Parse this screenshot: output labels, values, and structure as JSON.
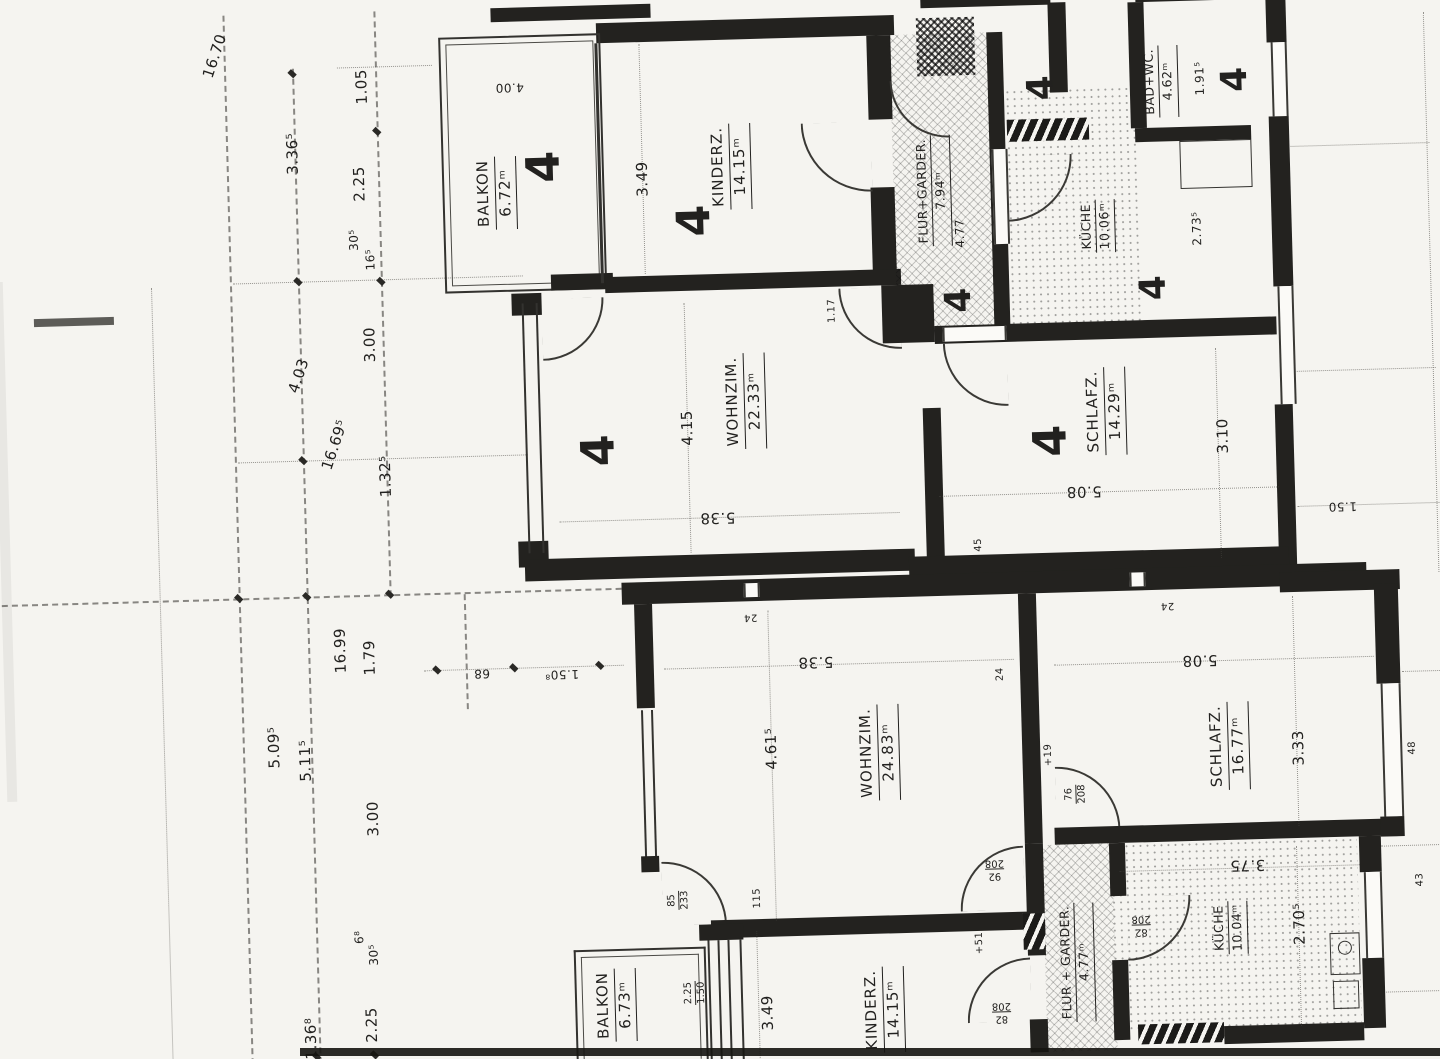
{
  "plan": {
    "unit_number": "4",
    "rooms": [
      {
        "name": "BALKON",
        "area": "6.72ᵐ"
      },
      {
        "name": "KINDERZ.",
        "area": "14.15ᵐ"
      },
      {
        "name": "WOHNZIM.",
        "area": "22.33ᵐ"
      },
      {
        "name": "FLUR+GARDER.",
        "area": "7.94ᵐ"
      },
      {
        "name": "KÜCHE",
        "area": "10.06ᵐ"
      },
      {
        "name": "BAD+WC.",
        "area": "4.62ᵐ"
      },
      {
        "name": "SCHLAFZ.",
        "area": "14.29ᵐ"
      },
      {
        "name": "WOHNZIM.",
        "area": "24.83ᵐ"
      },
      {
        "name": "SCHLAFZ.",
        "area": "16.77ᵐ"
      },
      {
        "name": "KÜCHE",
        "area": "10.04ᵐ"
      },
      {
        "name": "FLUR + GARDER.",
        "area": "4.77ᵐ"
      },
      {
        "name": "BALKON",
        "area": "6.73ᵐ"
      },
      {
        "name": "KINDERZ.",
        "area": "14.15ᵐ"
      }
    ],
    "dims": {
      "left": [
        "16.70",
        "3.36⁵",
        "1.05",
        "2.25",
        "30⁵",
        "16⁵",
        "3.00",
        "4.03",
        "16.69⁵",
        "1.32⁵",
        "16.99",
        "1.79",
        "5.09⁵",
        "5.11⁵",
        "3.00",
        "6⁸",
        "30⁵",
        "2.25",
        "1.36⁸"
      ],
      "upper": [
        "4.00",
        "3.49",
        "4.15",
        "5.38",
        "1.17",
        "4.77",
        "2.73⁵",
        "1.91⁵",
        "5.08",
        "3.10",
        "45"
      ],
      "lower": [
        "4.61⁵",
        "5.38",
        "24",
        "24",
        "24",
        "115",
        "5.08",
        "3.33",
        "3.75",
        "2.70⁵",
        "3.49",
        "68",
        "1.50⁸",
        "1.50",
        "48",
        "43",
        "+51",
        "+19"
      ],
      "windows": [
        "2.25",
        "1.50"
      ]
    },
    "doors": [
      {
        "w": "85",
        "h": "233"
      },
      {
        "w": "92",
        "h": "208"
      },
      {
        "w": "82",
        "h": "208"
      },
      {
        "w": "76",
        "h": "208"
      },
      {
        "w": "82",
        "h": "208"
      }
    ]
  }
}
